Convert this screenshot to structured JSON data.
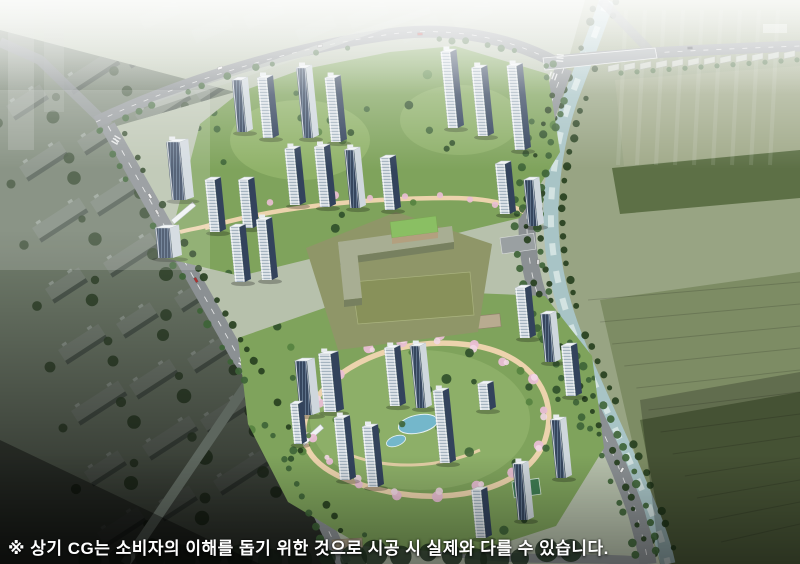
{
  "disclaimer": "※ 상기 CG는 소비자의 이해를 돕기 위한 것으로 시공 시 실제와 다를 수 있습니다.",
  "palette": {
    "base": "#b7c1ac",
    "field": "#98a483",
    "fieldMid": "#7d8c64",
    "fieldDark": "#55653f",
    "fieldBand": "#5d7046",
    "river": "#a8c4c6",
    "riverLight": "#ddebe8",
    "road": "#8b9093",
    "roadDark": "#5d665e",
    "lane": "#f2f3f3",
    "cityRoof": "#7e887c",
    "citySide": "#525d53",
    "cityTree": "#35482f",
    "lawn": "#7fa35c",
    "lawnLight": "#a9c77d",
    "tree": "#3e6437",
    "treeDark": "#27401f",
    "blossom": "#e9bed4",
    "path": "#ecd3ad",
    "pond": "#74b7cb",
    "towerFace": "#e3e9ee",
    "towerGlass": "#33435c",
    "towerGlassLight": "#5c7089",
    "towerRoof": "#f3f6f7",
    "schoolWall": "#b3a07f",
    "schoolRoof": "#a8ae93",
    "schoolRoofGreen": "#8abf63",
    "schoolField": "#8f9668",
    "greenhouse": "#cdd3c9",
    "court": "#3f7c52",
    "fog": "#ffffff",
    "textColor": "#ffffff"
  }
}
